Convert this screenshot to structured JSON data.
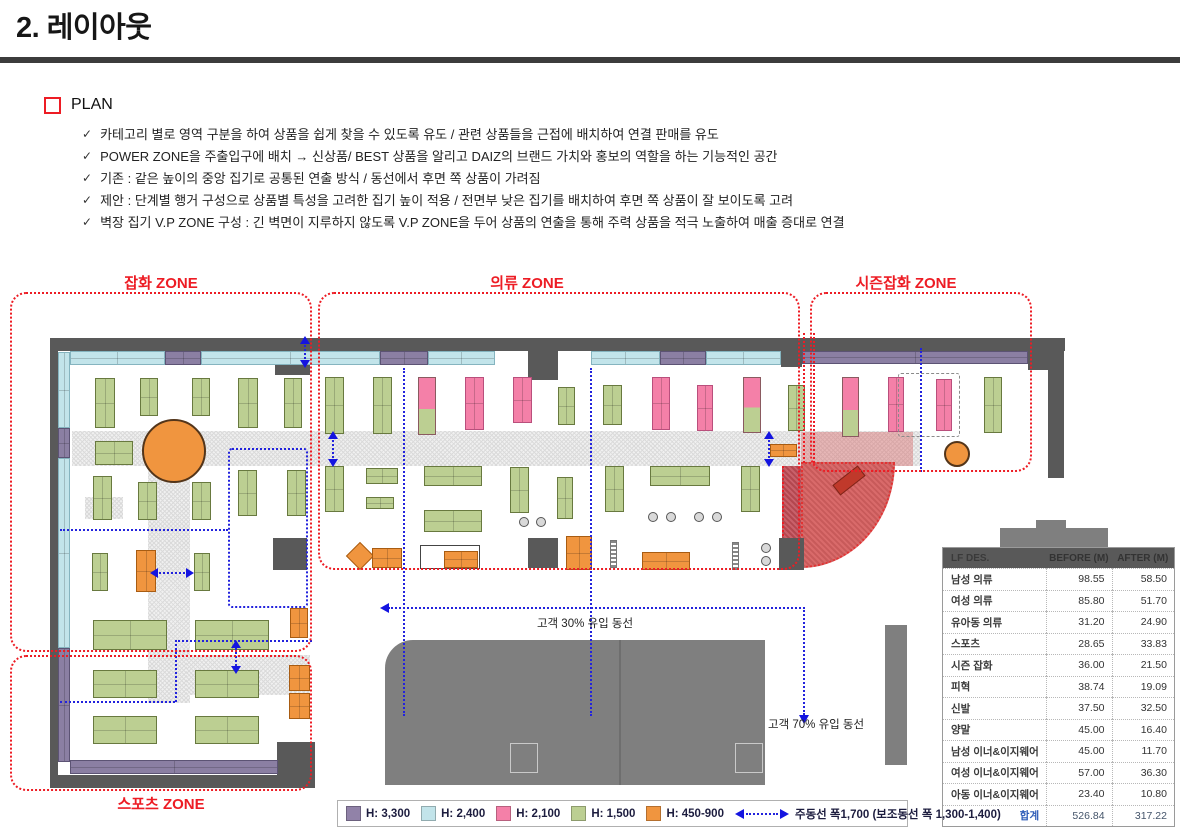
{
  "doc": {
    "title": "2. 레이아웃"
  },
  "plan_section": {
    "label": "PLAN",
    "check": "✓",
    "bullets": [
      "카테고리 별로 영역 구분을 하여 상품을 쉽게 찾을 수 있도록 유도 / 관련 상품들을 근접에 배치하여 연결 판매를 유도",
      "POWER ZONE을 주출입구에 배치 → 신상품/ BEST 상품을 알리고 DAIZ의 브랜드 가치와 홍보의 역할을 하는 기능적인 공간",
      "기존 : 같은 높이의 중앙 집기로 공통된 연출 방식 / 동선에서 후면 쪽 상품이 가려짐",
      "제안 : 단계별 행거 구성으로 상품별 특성을 고려한 집기 높이 적용 / 전면부 낮은 집기를 배치하여 후면 쪽 상품이 잘 보이도록 고려",
      "벽장 집기 V.P ZONE 구성 : 긴 벽면이 지루하지 않도록 V.P ZONE을 두어 상품의 연출을 통해 주력 상품을 적극 노출하여 매출 증대로 연결"
    ]
  },
  "zone_labels": {
    "japwha": "잡화 ZONE",
    "uiryu": "의류 ZONE",
    "season": "시즌잡화 ZONE",
    "sports": "스포츠 ZONE"
  },
  "callouts": {
    "power_zone": [
      "POWER",
      "ZONE"
    ],
    "show_window": [
      "SHOW",
      "WINDOW"
    ],
    "main_ent": [
      "MAIN",
      "ENT."
    ],
    "fitting_room": "F/R"
  },
  "flow_labels": {
    "flow30": "고객 30% 유입 동선",
    "flow70": "고객 70% 유입 동선"
  },
  "height_notes": [
    {
      "label": "H: 2,400",
      "cx": 683,
      "y": 371,
      "arrow_y": 352
    },
    {
      "label": "H: 2,100",
      "cx": 683,
      "y": 450,
      "arrow_y": 431
    },
    {
      "label": "H: 1,500",
      "cx": 683,
      "y": 500,
      "arrow_y": 481
    },
    {
      "label": "H: 450-900",
      "cx": 683,
      "y": 586,
      "arrow_y": 567
    }
  ],
  "top_sections": {
    "line": {
      "x1": 55,
      "x2": 1115,
      "y": 318
    },
    "ticks": [
      55,
      197,
      270,
      350,
      510,
      777,
      887,
      1013,
      1115
    ],
    "labels": [
      {
        "t": "란제리",
        "cx": 126
      },
      {
        "t": "아동 이너&이지웨어",
        "cx": 233
      },
      {
        "t": "유아동 의류",
        "cx": 310
      },
      {
        "t": "여성 의류",
        "cx": 430
      },
      {
        "t": "남성 의류",
        "cx": 660
      },
      {
        "t": "피혁",
        "cx": 832
      },
      {
        "t": "시즌 잡화",
        "cx": 950
      }
    ]
  },
  "left_sections": {
    "line": {
      "y1": 342,
      "y2": 768,
      "x": 62
    },
    "ticks": [
      342,
      529,
      647,
      705,
      768
    ],
    "labels": [
      {
        "t": "이너&이지웨어",
        "cy": 435
      },
      {
        "t": "남.여성 슈즈",
        "cy": 588
      },
      {
        "t": "스포츠화",
        "cy": 676
      },
      {
        "t": "스포츠",
        "cy": 737
      }
    ]
  },
  "table": {
    "headers": [
      "LF DES.",
      "BEFORE (M)",
      "AFTER (M)"
    ],
    "rows": [
      [
        "남성 의류",
        "98.55",
        "58.50"
      ],
      [
        "여성 의류",
        "85.80",
        "51.70"
      ],
      [
        "유아동 의류",
        "31.20",
        "24.90"
      ],
      [
        "스포츠",
        "28.65",
        "33.83"
      ],
      [
        "시즌 잡화",
        "36.00",
        "21.50"
      ],
      [
        "피혁",
        "38.74",
        "19.09"
      ],
      [
        "신발",
        "37.50",
        "32.50"
      ],
      [
        "양말",
        "45.00",
        "16.40"
      ],
      [
        "남성 이너&이지웨어",
        "45.00",
        "11.70"
      ],
      [
        "여성 이너&이지웨어",
        "57.00",
        "36.30"
      ],
      [
        "아동 이너&이지웨어",
        "23.40",
        "10.80"
      ]
    ],
    "total": [
      "합계",
      "526.84",
      "317.22"
    ]
  },
  "legend": {
    "items": [
      {
        "color": "#9182a8",
        "label": "H: 3,300"
      },
      {
        "color": "#c2e4ea",
        "label": "H: 2,400"
      },
      {
        "color": "#f480a8",
        "label": "H: 2,100"
      },
      {
        "color": "#bccf92",
        "label": "H: 1,500"
      },
      {
        "color": "#f0953f",
        "label": "H: 450-900"
      }
    ],
    "flow_label": "주동선 폭1,700 (보조동선 폭 1,300-1,400)"
  },
  "colors": {
    "accent_red": "#ed1c24",
    "accent_blue": "#1414e0",
    "dotted_blue": "#2222dd",
    "wall": "#595959",
    "mall": "#7f7f7f"
  },
  "plan_graphics": {
    "zones": [
      {
        "key": "japwha",
        "rect": [
          10,
          292,
          302,
          360
        ],
        "label_cx": 161,
        "label_y": 272
      },
      {
        "key": "uiryu",
        "rect": [
          318,
          292,
          482,
          278
        ],
        "label_cx": 527,
        "label_y": 272
      },
      {
        "key": "season",
        "rect": [
          810,
          292,
          222,
          180
        ],
        "label_cx": 906,
        "label_y": 272
      },
      {
        "key": "sports",
        "rect": [
          10,
          655,
          302,
          136
        ],
        "label_cx": 161,
        "label_y": 793
      }
    ],
    "walls": [
      [
        50,
        338,
        1015,
        13
      ],
      [
        50,
        338,
        8,
        450
      ],
      [
        50,
        775,
        265,
        13
      ],
      [
        1048,
        338,
        16,
        140
      ],
      [
        1028,
        340,
        24,
        30
      ],
      [
        781,
        341,
        21,
        26
      ],
      [
        528,
        346,
        30,
        34
      ],
      [
        779,
        538,
        25,
        32
      ],
      [
        277,
        742,
        38,
        34
      ],
      [
        275,
        350,
        35,
        25
      ],
      [
        273,
        538,
        34,
        32
      ],
      [
        528,
        538,
        30,
        30
      ]
    ],
    "mall": [
      [
        385,
        640,
        380,
        145
      ],
      [
        885,
        625,
        22,
        140
      ],
      [
        1000,
        528,
        108,
        19
      ],
      [
        1036,
        520,
        30,
        9
      ]
    ],
    "mall_notches": [
      [
        510,
        743,
        28,
        30
      ],
      [
        735,
        743,
        28,
        30
      ]
    ],
    "mall_divider": [
      619,
      640,
      2,
      145
    ],
    "aisles": [
      [
        72,
        431,
        848,
        35
      ],
      [
        148,
        431,
        42,
        272
      ],
      [
        85,
        497,
        38,
        22
      ],
      [
        187,
        655,
        123,
        40
      ]
    ],
    "fixtures": [
      [
        "c",
        70,
        351,
        95,
        14
      ],
      [
        "u",
        165,
        351,
        36,
        14
      ],
      [
        "c",
        201,
        351,
        179,
        14
      ],
      [
        "u",
        380,
        351,
        48,
        14
      ],
      [
        "c",
        428,
        351,
        67,
        14
      ],
      [
        "c",
        591,
        351,
        69,
        14
      ],
      [
        "u",
        660,
        351,
        46,
        14
      ],
      [
        "c",
        706,
        351,
        75,
        14
      ],
      [
        "u",
        802,
        351,
        226,
        13
      ],
      [
        "c",
        58,
        352,
        12,
        76
      ],
      [
        "u",
        58,
        428,
        12,
        30
      ],
      [
        "c",
        58,
        458,
        12,
        190
      ],
      [
        "u",
        58,
        648,
        12,
        114
      ],
      [
        "u",
        70,
        760,
        208,
        14
      ],
      [
        "g",
        95,
        378,
        20,
        50
      ],
      [
        "g",
        140,
        378,
        18,
        38
      ],
      [
        "g",
        192,
        378,
        18,
        38
      ],
      [
        "g",
        238,
        378,
        20,
        50
      ],
      [
        "g",
        284,
        378,
        18,
        50
      ],
      [
        "g",
        95,
        441,
        38,
        24
      ],
      [
        "circ",
        142,
        419,
        64,
        64
      ],
      [
        "g",
        93,
        476,
        19,
        44
      ],
      [
        "g",
        138,
        482,
        19,
        38
      ],
      [
        "g",
        192,
        482,
        19,
        38
      ],
      [
        "g",
        238,
        470,
        19,
        46
      ],
      [
        "g",
        287,
        470,
        19,
        46
      ],
      [
        "g",
        92,
        553,
        16,
        38
      ],
      [
        "o",
        136,
        550,
        20,
        42
      ],
      [
        "g",
        194,
        553,
        16,
        38
      ],
      [
        "o",
        290,
        608,
        18,
        30
      ],
      [
        "g",
        93,
        620,
        74,
        30
      ],
      [
        "g",
        195,
        620,
        74,
        30
      ],
      [
        "g",
        93,
        670,
        64,
        28
      ],
      [
        "g",
        195,
        670,
        64,
        28
      ],
      [
        "g",
        93,
        716,
        64,
        28
      ],
      [
        "g",
        195,
        716,
        64,
        28
      ],
      [
        "o",
        289,
        665,
        21,
        26
      ],
      [
        "o",
        289,
        693,
        21,
        26
      ],
      [
        "g",
        325,
        377,
        19,
        57
      ],
      [
        "g",
        373,
        377,
        19,
        57
      ],
      [
        "pg",
        418,
        377,
        18,
        58
      ],
      [
        "p",
        465,
        377,
        19,
        53
      ],
      [
        "p",
        513,
        377,
        19,
        46
      ],
      [
        "g",
        558,
        387,
        17,
        38
      ],
      [
        "g",
        603,
        385,
        19,
        40
      ],
      [
        "p",
        652,
        377,
        18,
        53
      ],
      [
        "p",
        697,
        385,
        16,
        46
      ],
      [
        "pg",
        743,
        377,
        18,
        56
      ],
      [
        "g",
        788,
        385,
        17,
        46
      ],
      [
        "pg",
        842,
        377,
        17,
        60
      ],
      [
        "p",
        888,
        377,
        16,
        55
      ],
      [
        "p",
        936,
        379,
        16,
        52
      ],
      [
        "g",
        984,
        377,
        18,
        56
      ],
      [
        "circ",
        944,
        441,
        26,
        26
      ],
      [
        "g",
        325,
        466,
        19,
        46
      ],
      [
        "g",
        366,
        468,
        32,
        16
      ],
      [
        "g",
        366,
        497,
        28,
        12
      ],
      [
        "g",
        424,
        466,
        58,
        20
      ],
      [
        "g",
        424,
        510,
        58,
        22
      ],
      [
        "g",
        510,
        467,
        19,
        46
      ],
      [
        "g",
        557,
        477,
        16,
        42
      ],
      [
        "g",
        605,
        466,
        19,
        46
      ],
      [
        "g",
        650,
        466,
        60,
        20
      ],
      [
        "g",
        741,
        466,
        19,
        46
      ],
      [
        "od",
        350,
        546,
        20,
        20
      ],
      [
        "o",
        372,
        548,
        30,
        20
      ],
      [
        "disp",
        420,
        545,
        60,
        24
      ],
      [
        "o",
        444,
        551,
        34,
        17
      ],
      [
        "o",
        566,
        536,
        26,
        34
      ],
      [
        "rk",
        610,
        540,
        7,
        28
      ],
      [
        "o",
        642,
        552,
        48,
        18
      ],
      [
        "rk",
        732,
        542,
        7,
        28
      ],
      [
        "o",
        770,
        444,
        27,
        13
      ]
    ],
    "chairs": [
      [
        648,
        512
      ],
      [
        666,
        512
      ],
      [
        694,
        512
      ],
      [
        712,
        512
      ],
      [
        519,
        517
      ],
      [
        536,
        517
      ],
      [
        761,
        543
      ],
      [
        761,
        556
      ]
    ],
    "blue_rects": [
      [
        228,
        448,
        80,
        160
      ]
    ],
    "blue_h": [
      [
        60,
        529,
        168
      ],
      [
        60,
        701,
        115
      ],
      [
        175,
        640,
        137
      ]
    ],
    "blue_v": [
      [
        403,
        368,
        348
      ],
      [
        590,
        368,
        348
      ],
      [
        920,
        348,
        124
      ],
      [
        175,
        640,
        62
      ]
    ],
    "dbl_arrows": [
      [
        "h",
        150,
        566,
        44
      ],
      [
        "v",
        326,
        431,
        36
      ],
      [
        "v",
        762,
        431,
        36
      ],
      [
        "v",
        229,
        640,
        34
      ],
      [
        "v",
        298,
        336,
        32
      ]
    ],
    "red_v": [
      [
        803,
        333,
        130
      ],
      [
        813,
        333,
        130
      ]
    ],
    "flow30": {
      "hx": 388,
      "hy": 607,
      "hlen": 417,
      "vx": 803,
      "vy": 607,
      "vlen": 108,
      "label_cx": 585,
      "label_y": 615
    },
    "flow70": {
      "label_x": 768,
      "label_y": 716
    },
    "power": {
      "strip": [
        782,
        466,
        19,
        74
      ],
      "curve": [
        801,
        462,
        94,
        106
      ],
      "bar": [
        833,
        474,
        32,
        13
      ],
      "overlay": [
        801,
        432,
        112,
        34
      ],
      "label_x": 836,
      "label_y": 500
    },
    "show_window": {
      "box": [
        1031,
        358,
        28,
        116
      ],
      "inner": [
        1036,
        406,
        16,
        44
      ],
      "label_x": 1068,
      "label_y": 388
    },
    "main_ent": {
      "chev_x": 1038,
      "chev_y": 490,
      "text_x": 1062,
      "text_y": 489
    },
    "fr_boxes": [
      [
        495,
        346,
        33,
        34
      ],
      [
        558,
        346,
        33,
        34
      ],
      [
        249,
        744,
        32,
        30
      ]
    ],
    "vp_dash": [
      898,
      373,
      62,
      64
    ]
  }
}
